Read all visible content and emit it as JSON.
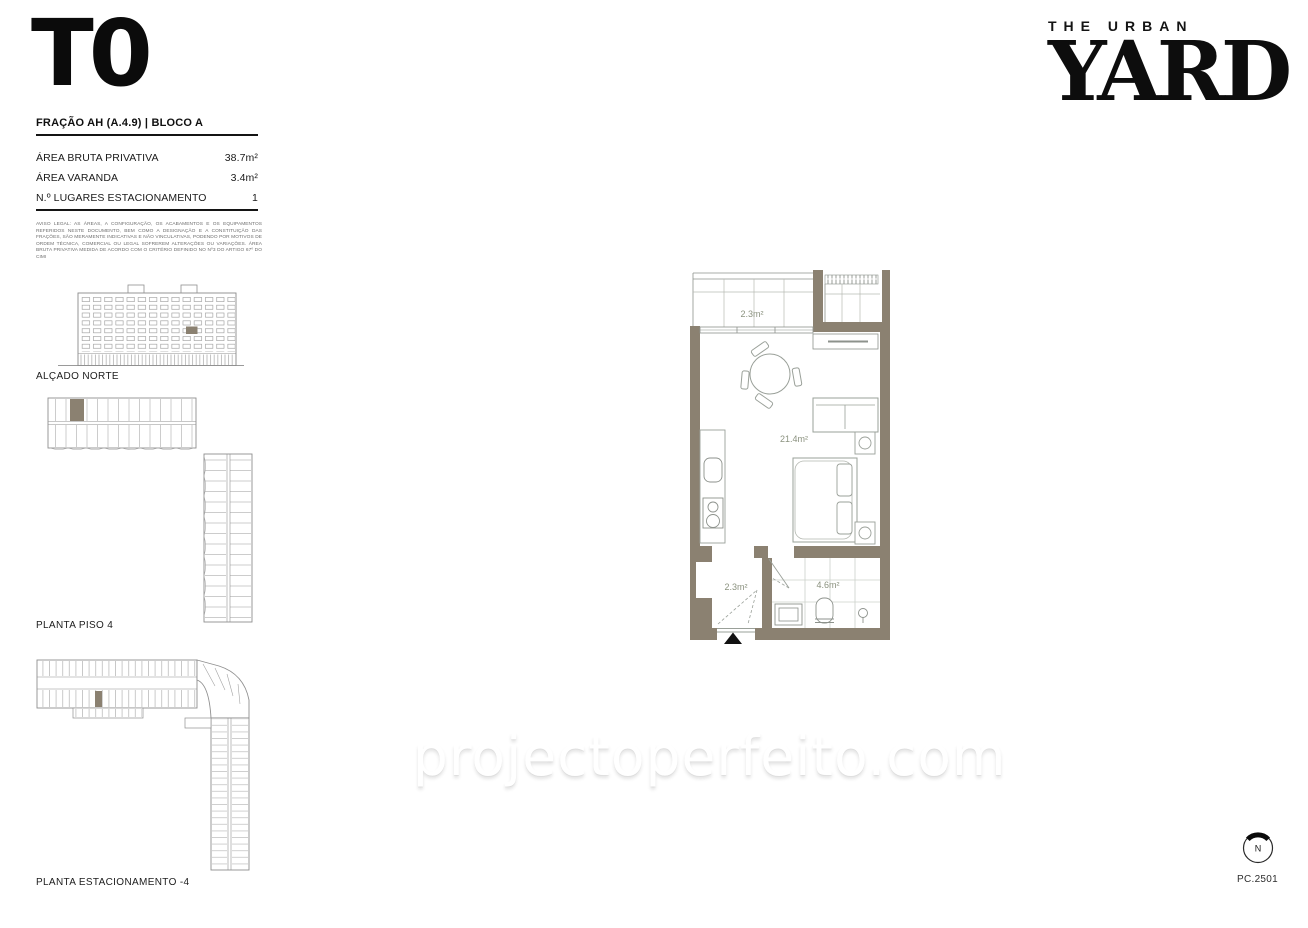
{
  "brand": {
    "line1": "THE URBAN",
    "line2": "YARD"
  },
  "unit": {
    "typology": "T0",
    "fraction": "FRAÇÃO AH (A.4.9) | BLOCO A"
  },
  "areas": {
    "rows": [
      {
        "label": "ÁREA BRUTA PRIVATIVA",
        "value": "38.7m²"
      },
      {
        "label": "ÁREA VARANDA",
        "value": "3.4m²"
      },
      {
        "label": "N.º LUGARES ESTACIONAMENTO",
        "value": "1"
      }
    ]
  },
  "legal": "AVISO LEGAL: AS ÁREAS, A CONFIGURAÇÃO, OS ACABAMENTOS E OS EQUIPAMENTOS REFERIDOS NESTE DOCUMENTO, BEM COMO A DESIGNAÇÃO E A CONSTITUIÇÃO DAS FRAÇÕES, SÃO MERAMENTE INDICATIVAS E NÃO VINCULATIVAS, PODENDO POR MOTIVOS DE ORDEM TÉCNICA, COMERCIAL OU LEGAL SOFREREM ALTERAÇÕES OU VARIAÇÕES. ÁREA BRUTA PRIVATIVA MEDIDA DE ACORDO COM O CRITÉRIO DEFINIDO NO Nº3 DO ARTIGO 67º DO CIMI",
  "drawings": {
    "elevation_label": "ALÇADO NORTE",
    "floor_label": "PLANTA PISO 4",
    "parking_label": "PLANTA ESTACIONAMENTO -4"
  },
  "floorplan": {
    "balcony_area": "2.3m²",
    "living_area": "21.4m²",
    "hall_area": "2.3m²",
    "bath_area": "4.6m²"
  },
  "compass": {
    "north": "N"
  },
  "footer": {
    "page_code": "PC.2501"
  },
  "watermark": "projectoperfeito.com",
  "colors": {
    "wall": "#8b8171",
    "drawing_line": "#8f948e",
    "area_label": "#8b927f"
  }
}
